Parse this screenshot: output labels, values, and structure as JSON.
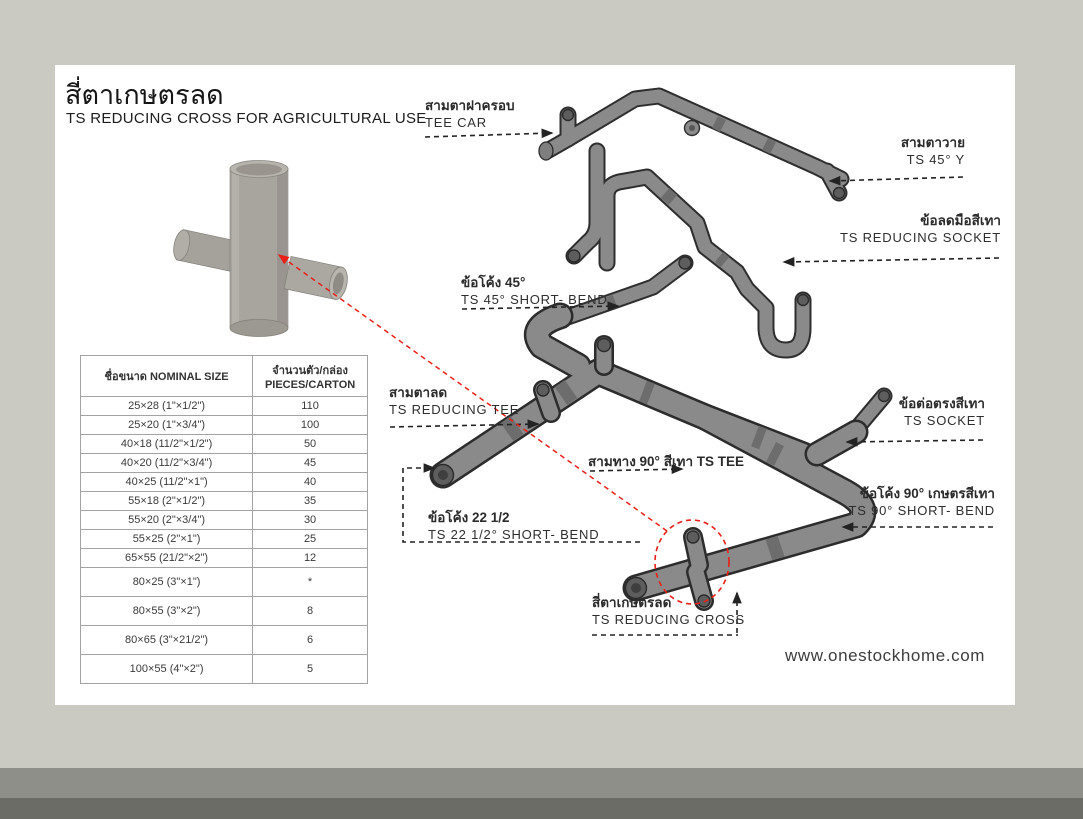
{
  "header": {
    "title_thai": "สี่ตาเกษตรลด",
    "title_en": "TS REDUCING CROSS FOR AGRICULTURAL USE"
  },
  "table": {
    "col1_header": "ชื่อขนาด NOMINAL SIZE",
    "col2_header_line1": "จำนวนตัว/กล่อง",
    "col2_header_line2": "PIECES/CARTON",
    "rows": [
      {
        "size": "25×28 (1\"×1/2\")",
        "pieces": "110"
      },
      {
        "size": "25×20 (1\"×3/4\")",
        "pieces": "100"
      },
      {
        "size": "40×18 (11/2\"×1/2\")",
        "pieces": "50"
      },
      {
        "size": "40×20 (11/2\"×3/4\")",
        "pieces": "45"
      },
      {
        "size": "40×25 (11/2\"×1\")",
        "pieces": "40"
      },
      {
        "size": "55×18 (2\"×1/2\")",
        "pieces": "35"
      },
      {
        "size": "55×20 (2\"×3/4\")",
        "pieces": "30"
      },
      {
        "size": "55×25 (2\"×1\")",
        "pieces": "25"
      },
      {
        "size": "65×55 (21/2\"×2\")",
        "pieces": "12"
      },
      {
        "size": "80×25 (3\"×1\")",
        "pieces": "*"
      },
      {
        "size": "80×55 (3\"×2\")",
        "pieces": "8"
      },
      {
        "size": "80×65 (3\"×21/2\")",
        "pieces": "6"
      },
      {
        "size": "100×55 (4\"×2\")",
        "pieces": "5"
      }
    ]
  },
  "diagram": {
    "labels": {
      "tee_cap": {
        "thai": "สามตาฝาครอบ",
        "en": "TEE CAR"
      },
      "ts45y": {
        "thai": "สามตาวาย",
        "en": "TS 45° Y"
      },
      "reducing_socket": {
        "thai": "ข้อลดมือสีเทา",
        "en": "TS REDUCING SOCKET"
      },
      "bend45": {
        "thai": "ข้อโค้ง 45°",
        "en": "TS 45° SHORT- BEND"
      },
      "reducing_tee": {
        "thai": "สามตาลด",
        "en": "TS REDUCING TEE"
      },
      "socket": {
        "thai": "ข้อต่อตรงสีเทา",
        "en": "TS SOCKET"
      },
      "bend90": {
        "thai": "ข้อโค้ง 90° เกษตรสีเทา",
        "en": "TS 90° SHORT- BEND"
      },
      "bend225": {
        "thai": "ข้อโค้ง 22 1/2",
        "en": "TS 22 1/2° SHORT- BEND"
      },
      "reducing_cross": {
        "thai": "สี่ตาเกษตรลด",
        "en": "TS REDUCING CROSS"
      }
    },
    "tee90_line": "สามทาง 90° สีเทา TS TEE",
    "annotation_red": "#e82017"
  },
  "footer": {
    "website": "www.onestockhome.com"
  }
}
